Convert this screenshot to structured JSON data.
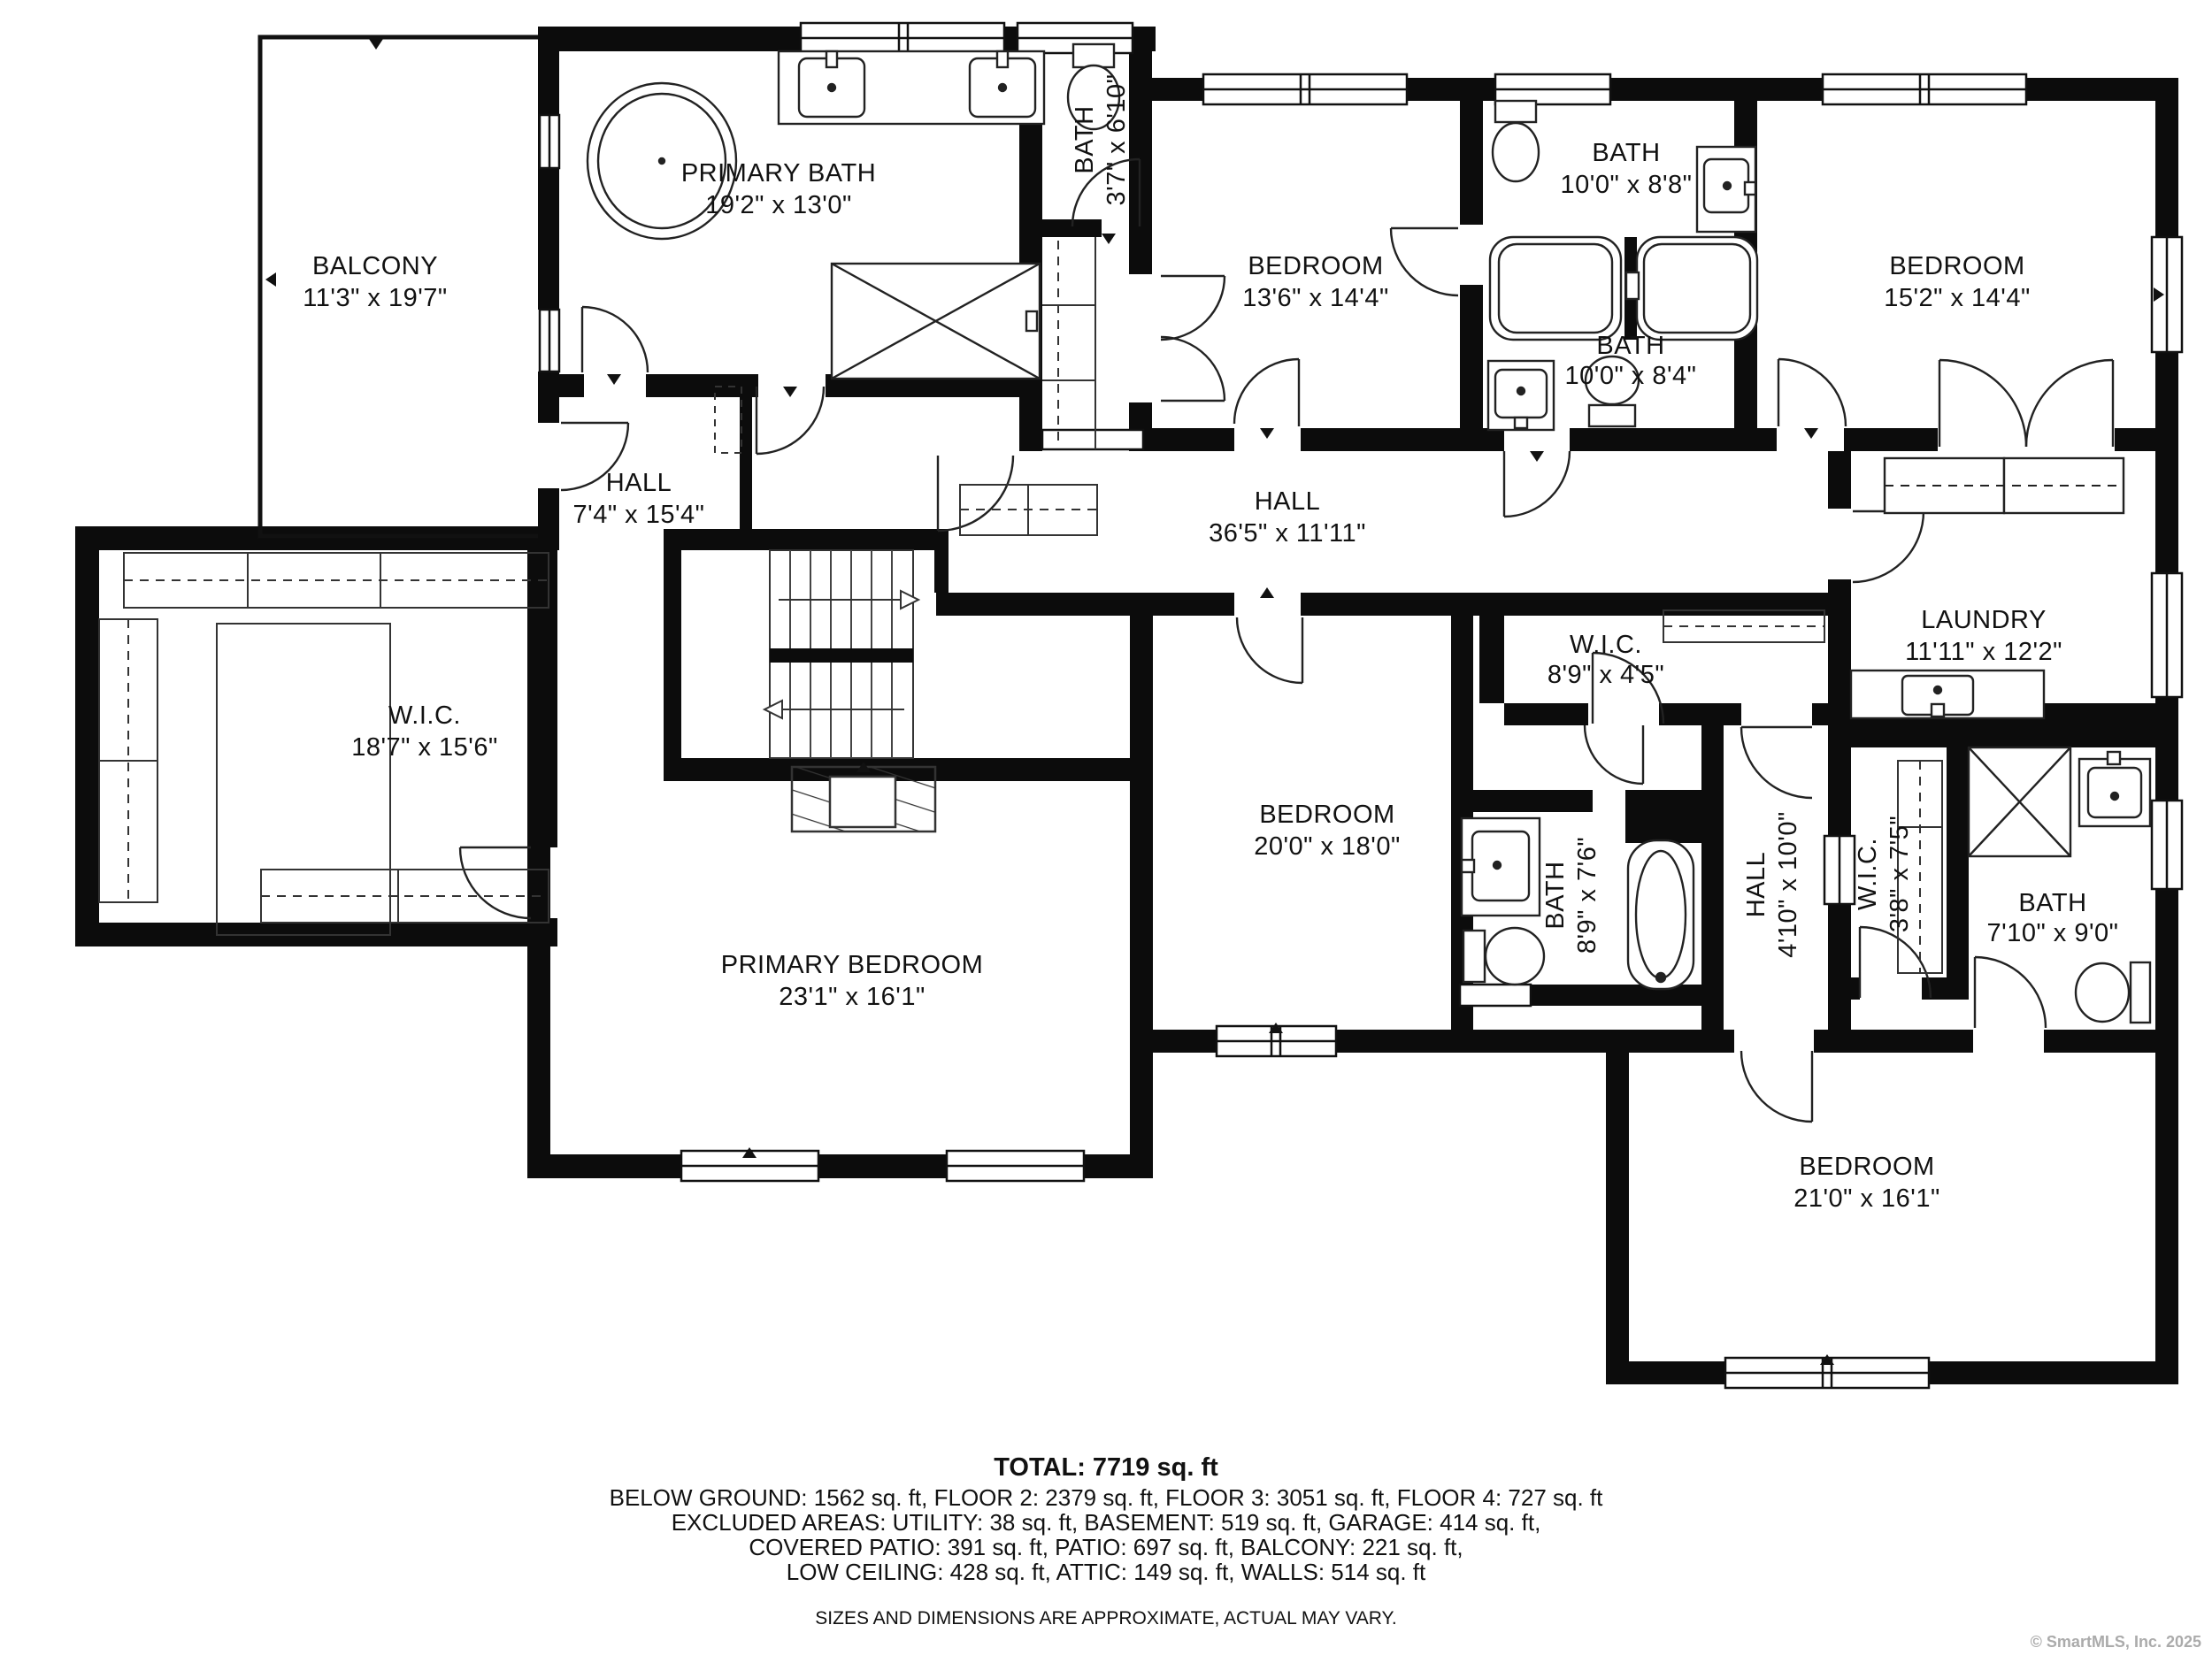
{
  "rooms": {
    "balcony": {
      "label": "BALCONY",
      "dims": "11'3\" x 19'7\""
    },
    "primary_bath": {
      "label": "PRIMARY BATH",
      "dims": "19'2\" x 13'0\""
    },
    "bath_small": {
      "label": "BATH",
      "dims": "3'7\" x 6'10\""
    },
    "bedroom_13": {
      "label": "BEDROOM",
      "dims": "13'6\" x 14'4\""
    },
    "bath_88": {
      "label": "BATH",
      "dims": "10'0\" x 8'8\""
    },
    "bedroom_15": {
      "label": "BEDROOM",
      "dims": "15'2\" x 14'4\""
    },
    "bath_84": {
      "label": "BATH",
      "dims": "10'0\" x 8'4\""
    },
    "hall_upper": {
      "label": "HALL",
      "dims": "7'4\" x 15'4\""
    },
    "hall_main": {
      "label": "HALL",
      "dims": "36'5\" x 11'11\""
    },
    "wic_primary": {
      "label": "W.I.C.",
      "dims": "18'7\" x 15'6\""
    },
    "laundry": {
      "label": "LAUNDRY",
      "dims": "11'11\" x 12'2\""
    },
    "wic_89": {
      "label": "W.I.C.",
      "dims": "8'9\" x 4'5\""
    },
    "bedroom_20": {
      "label": "BEDROOM",
      "dims": "20'0\" x 18'0\""
    },
    "primary_bedroom": {
      "label": "PRIMARY BEDROOM",
      "dims": "23'1\" x 16'1\""
    },
    "bath_89": {
      "label": "BATH",
      "dims": "8'9\" x 7'6\""
    },
    "hall_410": {
      "label": "HALL",
      "dims": "4'10\" x 10'0\""
    },
    "wic_38": {
      "label": "W.I.C.",
      "dims": "3'8\" x 7'5\""
    },
    "bath_710": {
      "label": "BATH",
      "dims": "7'10\" x 9'0\""
    },
    "bedroom_21": {
      "label": "BEDROOM",
      "dims": "21'0\" x 16'1\""
    }
  },
  "summary": {
    "total": "TOTAL: 7719 sq. ft",
    "line1": "BELOW GROUND: 1562 sq. ft, FLOOR 2: 2379 sq. ft, FLOOR 3: 3051 sq. ft, FLOOR 4: 727 sq. ft",
    "line2": "EXCLUDED AREAS: UTILITY: 38 sq. ft, BASEMENT: 519 sq. ft, GARAGE: 414 sq. ft,",
    "line3": "COVERED PATIO: 391 sq. ft, PATIO: 697 sq. ft, BALCONY: 221 sq. ft,",
    "line4": "LOW CEILING: 428 sq. ft, ATTIC: 149 sq. ft, WALLS: 514 sq. ft",
    "disclaimer": "SIZES AND DIMENSIONS ARE APPROXIMATE, ACTUAL MAY VARY."
  },
  "copyright": "© SmartMLS, Inc.  2025"
}
